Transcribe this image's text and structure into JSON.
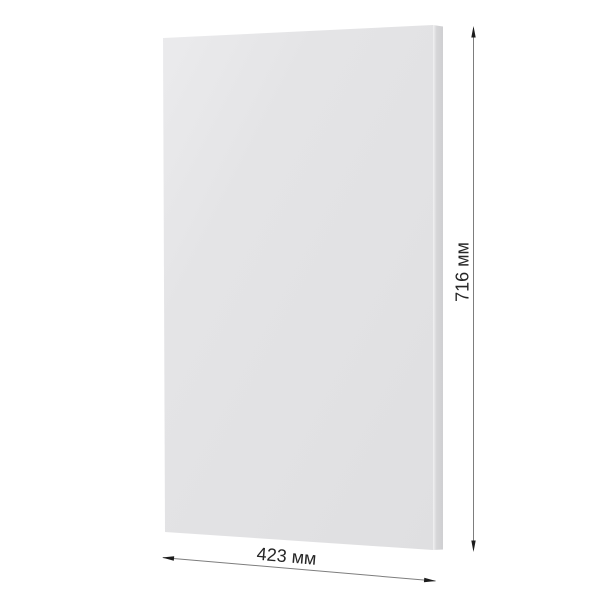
{
  "page": {
    "background_color": "#ffffff"
  },
  "panel": {
    "face_color_light": "#ebebed",
    "face_color": "#e3e3e5",
    "face_color_dark": "#dfdfe1",
    "edge_color": "#d6d6d8",
    "edge_highlight_color": "#f2f2f3"
  },
  "dimensions": {
    "height": {
      "label": "716 мм",
      "value": 716,
      "unit": "мм"
    },
    "width": {
      "label": "423 мм",
      "value": 423,
      "unit": "мм"
    },
    "line_color": "#7d7d7d",
    "arrow_color": "#1c1c1c",
    "text_color": "#262626"
  }
}
